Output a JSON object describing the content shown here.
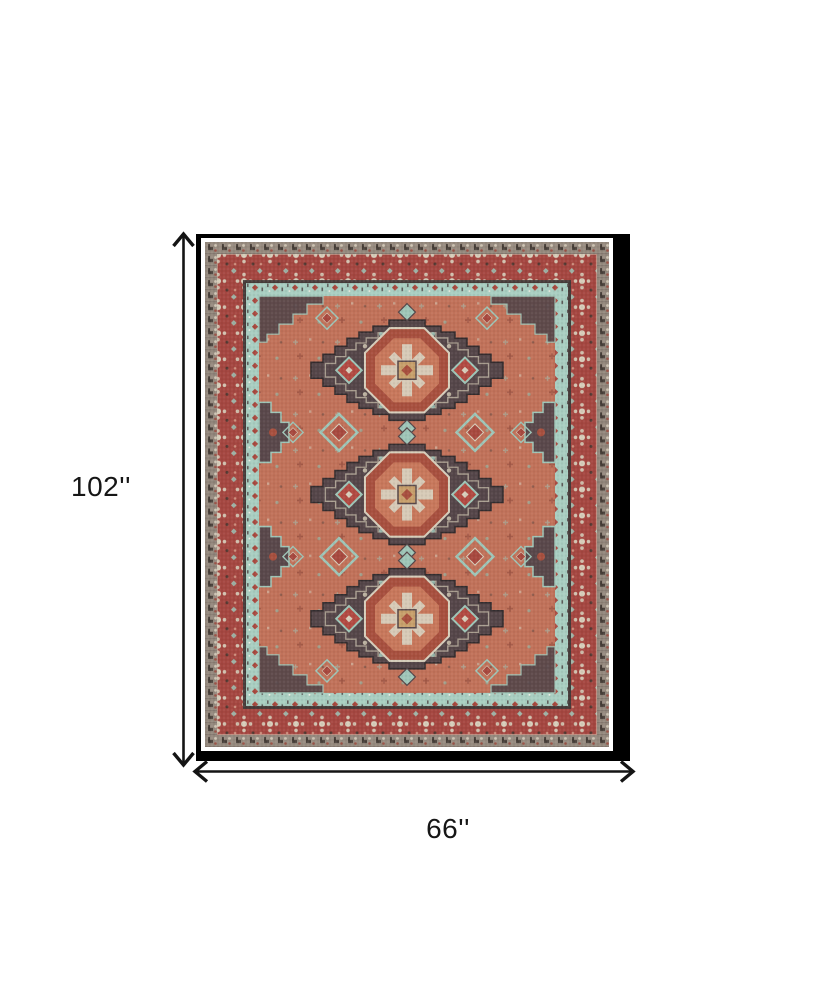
{
  "page": {
    "background_color": "#ffffff"
  },
  "dimension_figure": {
    "height_label": "102''",
    "width_label": "66''",
    "arrow_color": "#141414",
    "label_color": "#161616"
  },
  "rug": {
    "frame_color": "#000000",
    "mat_color": "#ffffff",
    "palette": {
      "field_terracotta": "#c1725a",
      "border_red": "#a54741",
      "border_teal": "#a9cec1",
      "border_taupe": "#978b80",
      "medallion_charcoal": "#554649",
      "accent_cream": "#d8cfbc",
      "accent_tan": "#c8a06c",
      "accent_dark_red": "#a8503f",
      "dark_line": "#473c3a"
    }
  }
}
